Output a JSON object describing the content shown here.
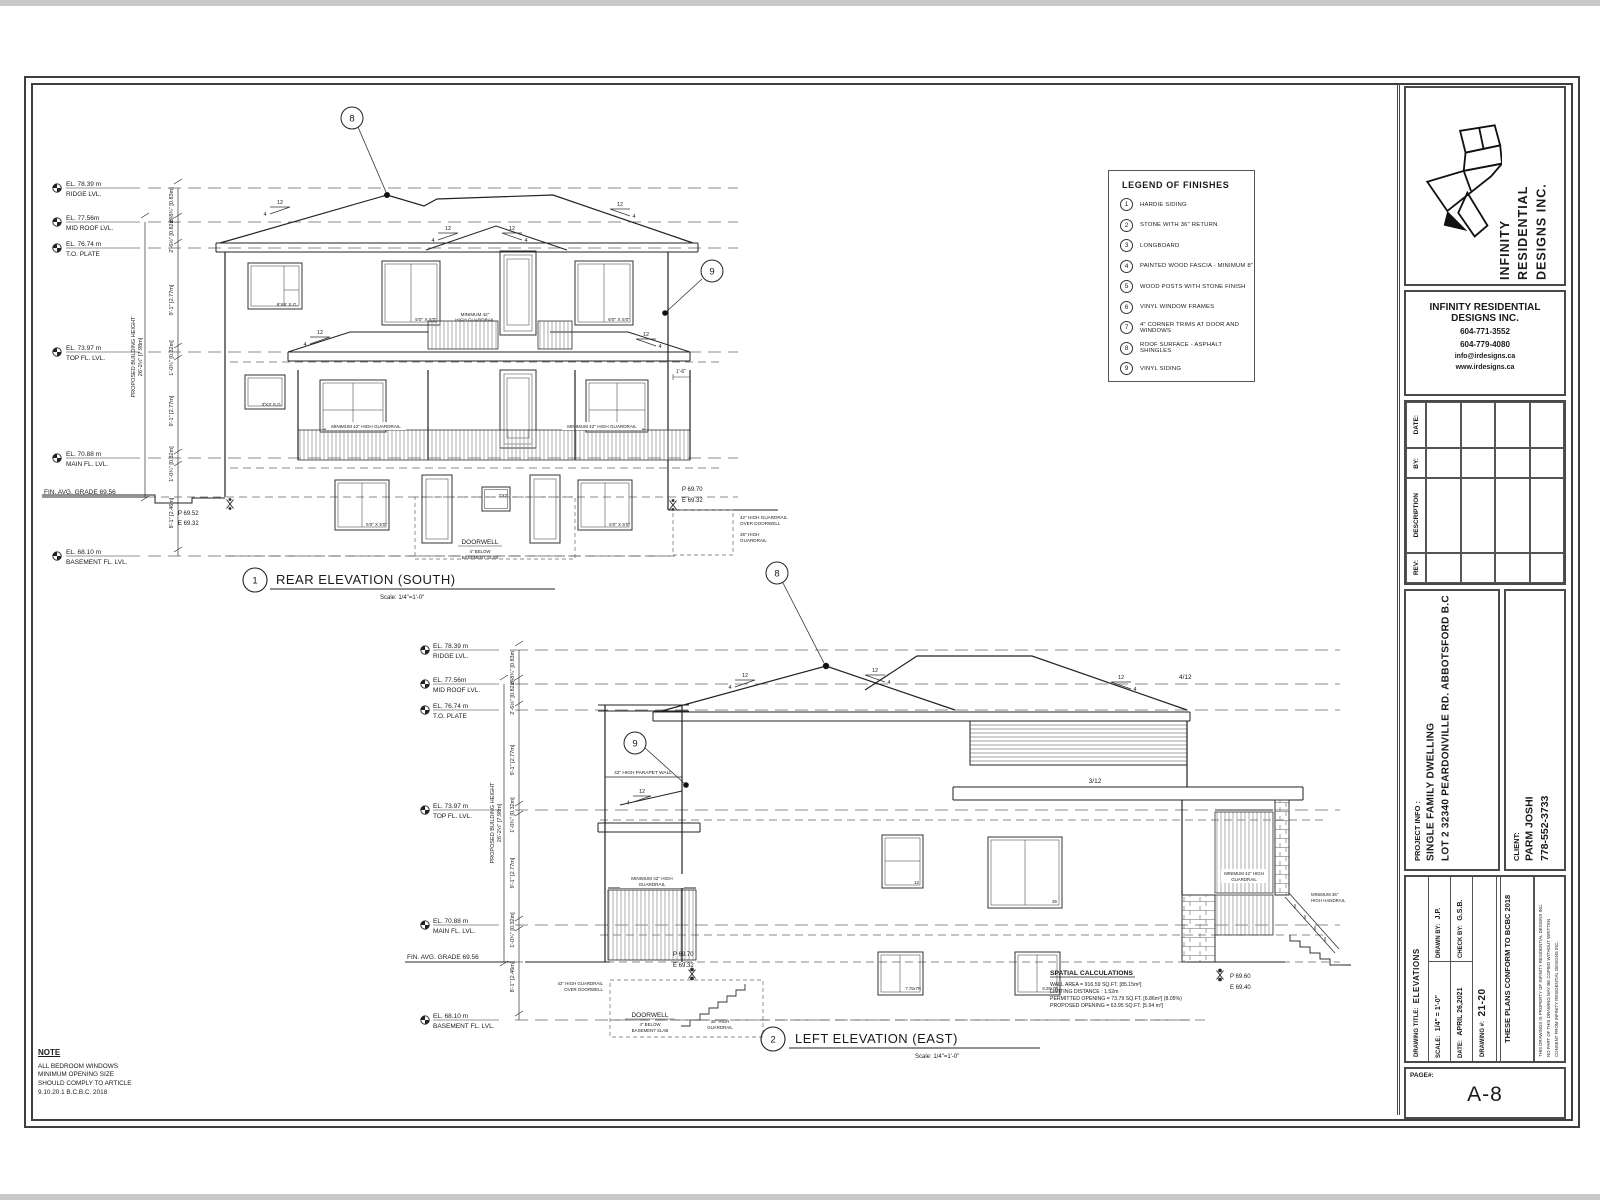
{
  "legend": {
    "title": "LEGEND OF FINISHES",
    "items": [
      {
        "num": "1",
        "label": "HARDIE SIDING"
      },
      {
        "num": "2",
        "label": "STONE WITH 36\" RETURN"
      },
      {
        "num": "3",
        "label": "LONGBOARD"
      },
      {
        "num": "4",
        "label": "PAINTED WOOD FASCIA - MINIMUM 8\""
      },
      {
        "num": "5",
        "label": "WOOD POSTS WITH STONE FINISH"
      },
      {
        "num": "6",
        "label": "VINYL WINDOW FRAMES"
      },
      {
        "num": "7",
        "label": "4\" CORNER TRIMS AT DOOR AND WINDOWS"
      },
      {
        "num": "8",
        "label": "ROOF SURFACE - ASPHALT SHINGLES"
      },
      {
        "num": "9",
        "label": "VINYL SIDING"
      }
    ]
  },
  "levels": {
    "ridge_el": "EL. 78.39 m",
    "ridge": "RIDGE LVL.",
    "midroof_el": "EL. 77.56m",
    "midroof": "MID ROOF LVL.",
    "plate_el": "EL. 76.74 m",
    "plate": "T.O. PLATE",
    "topfl_el": "EL. 73.97 m",
    "topfl": "TOP FL. LVL.",
    "mainfl_el": "EL. 70.88 m",
    "mainfl": "MAIN FL. LVL.",
    "grade": "FIN. AVG. GRADE  69.56",
    "bsmt_el": "EL. 68.10 m",
    "bsmt": "BASEMENT FL. LVL."
  },
  "dims": {
    "height_label": "PROPOSED BUILDING HEIGHT",
    "height_value": "26'-2½\" [7.98m]",
    "d_ridge": "2'-8¾\" [0.83m]",
    "d_plate": "2'-6½\" [0.82m]",
    "d_story": "9'-1\" [2.77m]",
    "d_floor": "1'-0¾\" [0.32m]",
    "d_bsmt": "8'-1\" [2.46m]",
    "d_eave": "1'-6\""
  },
  "pitch": {
    "rise": "12",
    "run": "4",
    "r412": "4/12",
    "r312": "3/12"
  },
  "callouts": {
    "c8": "8",
    "c9": "9"
  },
  "rear": {
    "num": "1",
    "title": "REAR ELEVATION (SOUTH)",
    "scale": "Scale: 1/4\"=1'-0\"",
    "p_left": "P 69.52",
    "e_left": "E 69.32",
    "p_right": "P 69.70",
    "e_right": "E 69.32",
    "guard42": "42\" HIGH GUARDRAIL",
    "guard42b": "OVER DOORWELL",
    "guard36": "36\" HIGH",
    "guard36b": "GUARDRAIL",
    "min_guard": "MINIMUM 42\" HIGH GUARDRAIL",
    "min_guard_a": "MINIMUM 42\"",
    "min_guard_b": "HIGH GUARDRAIL",
    "doorwell": "DOORWELL",
    "doorwell2": "4\" BELOW",
    "doorwell3": "BASEMENT SLAB",
    "w_6x6": "6'X6' S.G.",
    "w_5050": "5'0\" X 5'0\"",
    "w_6050": "6'0\" X 5'0\"",
    "w_3x3": "3'X3' S.G.",
    "w_3x2": "3'X2'"
  },
  "left": {
    "num": "2",
    "title": "LEFT ELEVATION (EAST)",
    "scale": "Scale: 1/4\"=1'-0\"",
    "p1": "P 69.70",
    "e1": "E 69.32",
    "p2": "P 69.60",
    "e2": "E 69.40",
    "parapet": "42\" HIGH PARAPET WALL",
    "min_guard1": "MINIMUM 42\" HIGH",
    "min_guard1b": "GUARDRAIL",
    "handrail": "MINIMUM 36\"",
    "handrailb": "HIGH HANDRAIL",
    "guard42": "42\" HIGH GUARDRAIL",
    "guard42b": "OVER DOORWELL",
    "guard36": "36\" HIGH",
    "guard36b": "GUARDRAIL",
    "doorwell": "DOORWELL",
    "doorwell2": "4\" BELOW",
    "doorwell3": "BASEMENT SLAB",
    "w12": "12",
    "w36": "36",
    "wb1": "7.75x7R",
    "wb2": "8.29x7R",
    "spatial_title": "SPATIAL CALCULATIONS",
    "spatial1": "WALL  AREA  = 916.59 SQ.FT. [85.15m²]",
    "spatial2": "LIMITING DISTANCE :  1.52m",
    "spatial3": "PERMITTED OPENING  = 73.79 SQ.FT. [6.86m²] (8.05%)",
    "spatial4": "PROPOSED OPENING = 63.95 SQ.FT. [5.94 m²]"
  },
  "note": {
    "title": "NOTE",
    "lines": [
      "ALL BEDROOM WINDOWS",
      "MINIMUM OPENING SIZE",
      "SHOULD COMPLY TO ARTICLE",
      "9.10.20.1 B.C.B.C. 2018"
    ]
  },
  "titleblock": {
    "company1": "INFINITY",
    "company2": "RESIDENTIAL",
    "company3": "DESIGNS INC.",
    "contact_name1": "INFINITY RESIDENTIAL",
    "contact_name2": "DESIGNS INC.",
    "phone1": "604-771-3552",
    "phone2": "604-779-4080",
    "email": "info@irdesigns.ca",
    "web": "www.irdesigns.ca",
    "rev": "REV:",
    "desc": "DESCRIPTION",
    "by": "BY:",
    "date_h": "DATE:",
    "project_label": "PROJECT INFO :",
    "project1": "SINGLE FAMILY DWELLING",
    "project2": "LOT 2 32340 PEARDONVILLE RD. ABBOTSFORD B.C",
    "client_label": "CLIENT:",
    "client_name": "PARM JOSHI",
    "client_phone": "778-552-3733",
    "drawing_title_label": "DRAWING TITLE:",
    "drawing_title": "ELEVATIONS",
    "scale_label": "SCALE:",
    "scale": "1/4\" = 1'-0\"",
    "drawn_label": "DRAWN BY:",
    "drawn": "J.P.",
    "check_label": "CHECK BY:",
    "check": "G.S.B.",
    "date_label": "DATE:",
    "date": "APRIL 26,2021",
    "dwgnum_label": "DRAWING #:",
    "dwgnum": "21-20",
    "conform": "THESE PLANS CONFORM TO BCBC 2018",
    "disclaimer1": "THIS DRAWINGS IS PROPERTY OF INFINITY RESIDENTIAL DESIGNS INC.",
    "disclaimer2": "NO PART OF THIS DRAWING MAY BE COPIED WITHOUT WRITTEN",
    "disclaimer3": "CONSENT FROM INFINITY RESIDENTIAL DESIGNS INC.",
    "page_label": "PAGE#:",
    "page": "A-8"
  }
}
